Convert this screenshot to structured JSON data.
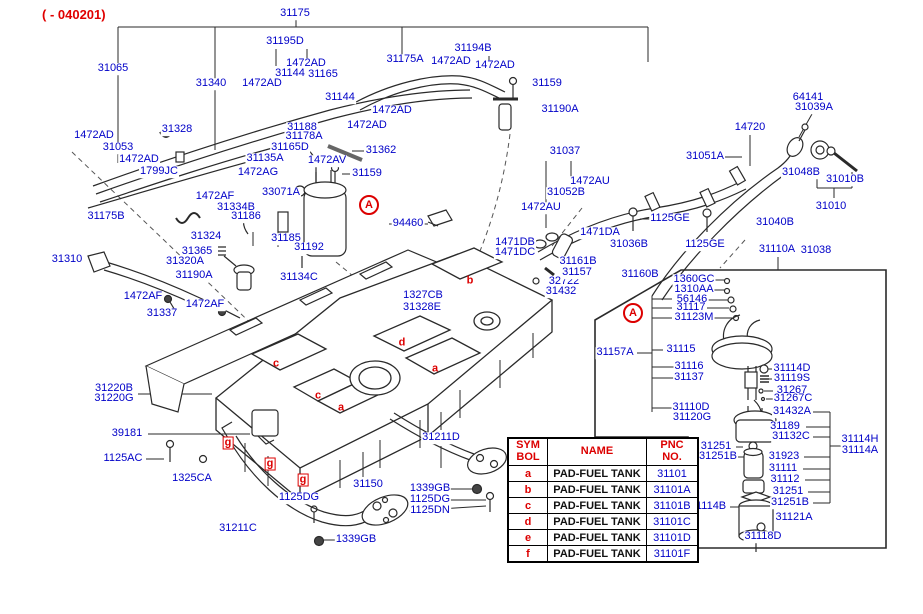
{
  "header": {
    "revision_code": "( - 040201)"
  },
  "colors": {
    "part_label": "#0000c8",
    "accent_red": "#dc0000",
    "line": "#2a2a2a",
    "background": "#ffffff"
  },
  "part_labels": [
    {
      "text": "31175",
      "x": 295,
      "y": 14
    },
    {
      "text": "31195D",
      "x": 285,
      "y": 42
    },
    {
      "text": "31065",
      "x": 113,
      "y": 69
    },
    {
      "text": "31340",
      "x": 211,
      "y": 84
    },
    {
      "text": "1472AD",
      "x": 306,
      "y": 64
    },
    {
      "text": "31144",
      "x": 290,
      "y": 74
    },
    {
      "text": "31165",
      "x": 323,
      "y": 75
    },
    {
      "text": "1472AD",
      "x": 262,
      "y": 84
    },
    {
      "text": "31144",
      "x": 340,
      "y": 98
    },
    {
      "text": "31175A",
      "x": 405,
      "y": 60
    },
    {
      "text": "1472AD",
      "x": 451,
      "y": 62
    },
    {
      "text": "31194B",
      "x": 473,
      "y": 49
    },
    {
      "text": "1472AD",
      "x": 495,
      "y": 66
    },
    {
      "text": "31159",
      "x": 547,
      "y": 84
    },
    {
      "text": "31190A",
      "x": 560,
      "y": 110
    },
    {
      "text": "1472AD",
      "x": 392,
      "y": 111
    },
    {
      "text": "1472AD",
      "x": 367,
      "y": 126
    },
    {
      "text": "31188",
      "x": 302,
      "y": 128
    },
    {
      "text": "31178A",
      "x": 304,
      "y": 137
    },
    {
      "text": "31165D",
      "x": 290,
      "y": 148
    },
    {
      "text": "31362",
      "x": 381,
      "y": 151
    },
    {
      "text": "31135A",
      "x": 265,
      "y": 159
    },
    {
      "text": "1472AG",
      "x": 258,
      "y": 173
    },
    {
      "text": "1472AV",
      "x": 327,
      "y": 161
    },
    {
      "text": "31159",
      "x": 367,
      "y": 174
    },
    {
      "text": "1472AD",
      "x": 94,
      "y": 136
    },
    {
      "text": "31053",
      "x": 118,
      "y": 148
    },
    {
      "text": "31328",
      "x": 177,
      "y": 130
    },
    {
      "text": "1472AD",
      "x": 139,
      "y": 160
    },
    {
      "text": "1799JC",
      "x": 159,
      "y": 172
    },
    {
      "text": "33071A",
      "x": 281,
      "y": 193
    },
    {
      "text": "1472AF",
      "x": 215,
      "y": 197
    },
    {
      "text": "31334B",
      "x": 236,
      "y": 208
    },
    {
      "text": "31186",
      "x": 246,
      "y": 217
    },
    {
      "text": "31175B",
      "x": 106,
      "y": 217
    },
    {
      "text": "31324",
      "x": 206,
      "y": 237
    },
    {
      "text": "31310",
      "x": 67,
      "y": 260
    },
    {
      "text": "31365",
      "x": 197,
      "y": 252
    },
    {
      "text": "31320A",
      "x": 185,
      "y": 262
    },
    {
      "text": "31190A",
      "x": 194,
      "y": 276
    },
    {
      "text": "94460",
      "x": 408,
      "y": 224
    },
    {
      "text": "31185",
      "x": 286,
      "y": 239
    },
    {
      "text": "31192",
      "x": 309,
      "y": 248
    },
    {
      "text": "31134C",
      "x": 299,
      "y": 278
    },
    {
      "text": "31337",
      "x": 162,
      "y": 314
    },
    {
      "text": "1472AF",
      "x": 143,
      "y": 297
    },
    {
      "text": "1472AF",
      "x": 205,
      "y": 305
    },
    {
      "text": "1327CB",
      "x": 423,
      "y": 296
    },
    {
      "text": "31328E",
      "x": 422,
      "y": 308
    },
    {
      "text": "31220B",
      "x": 114,
      "y": 389
    },
    {
      "text": "31220G",
      "x": 114,
      "y": 399
    },
    {
      "text": "39181",
      "x": 127,
      "y": 434
    },
    {
      "text": "1125AC",
      "x": 123,
      "y": 459
    },
    {
      "text": "1325CA",
      "x": 192,
      "y": 479
    },
    {
      "text": "1125DG",
      "x": 299,
      "y": 498
    },
    {
      "text": "31211C",
      "x": 238,
      "y": 529
    },
    {
      "text": "1339GB",
      "x": 356,
      "y": 540
    },
    {
      "text": "31150",
      "x": 368,
      "y": 485
    },
    {
      "text": "31211D",
      "x": 441,
      "y": 438
    },
    {
      "text": "1339GB",
      "x": 430,
      "y": 489
    },
    {
      "text": "1125DG",
      "x": 430,
      "y": 500
    },
    {
      "text": "1125DN",
      "x": 430,
      "y": 511
    },
    {
      "text": "31037",
      "x": 565,
      "y": 152
    },
    {
      "text": "1472AU",
      "x": 590,
      "y": 182
    },
    {
      "text": "31052B",
      "x": 566,
      "y": 193
    },
    {
      "text": "1472AU",
      "x": 541,
      "y": 208
    },
    {
      "text": "31051A",
      "x": 705,
      "y": 157
    },
    {
      "text": "1125GE",
      "x": 670,
      "y": 219
    },
    {
      "text": "1471DB",
      "x": 515,
      "y": 243
    },
    {
      "text": "1471DC",
      "x": 515,
      "y": 253
    },
    {
      "text": "1471DA",
      "x": 600,
      "y": 233
    },
    {
      "text": "31036B",
      "x": 629,
      "y": 245
    },
    {
      "text": "1125GE",
      "x": 705,
      "y": 245
    },
    {
      "text": "32722",
      "x": 564,
      "y": 282
    },
    {
      "text": "31432",
      "x": 561,
      "y": 292
    },
    {
      "text": "31161B",
      "x": 578,
      "y": 262
    },
    {
      "text": "31157",
      "x": 577,
      "y": 273
    },
    {
      "text": "31160B",
      "x": 640,
      "y": 275
    },
    {
      "text": "14720",
      "x": 750,
      "y": 128
    },
    {
      "text": "64141",
      "x": 808,
      "y": 98
    },
    {
      "text": "31039A",
      "x": 814,
      "y": 108
    },
    {
      "text": "31048B",
      "x": 801,
      "y": 173
    },
    {
      "text": "31010B",
      "x": 845,
      "y": 180
    },
    {
      "text": "31010",
      "x": 831,
      "y": 207
    },
    {
      "text": "31040B",
      "x": 775,
      "y": 223
    },
    {
      "text": "31110A",
      "x": 777,
      "y": 250
    },
    {
      "text": "31038",
      "x": 816,
      "y": 251
    },
    {
      "text": "1360GC",
      "x": 694,
      "y": 280
    },
    {
      "text": "1310AA",
      "x": 694,
      "y": 290
    },
    {
      "text": "56146",
      "x": 692,
      "y": 300
    },
    {
      "text": "31117",
      "x": 691,
      "y": 308
    },
    {
      "text": "31123M",
      "x": 694,
      "y": 318
    },
    {
      "text": "31157A",
      "x": 615,
      "y": 353
    },
    {
      "text": "31115",
      "x": 681,
      "y": 350
    },
    {
      "text": "31116",
      "x": 689,
      "y": 367
    },
    {
      "text": "31137",
      "x": 689,
      "y": 378
    },
    {
      "text": "31114D",
      "x": 792,
      "y": 369
    },
    {
      "text": "31119S",
      "x": 792,
      "y": 379
    },
    {
      "text": "31267",
      "x": 792,
      "y": 391
    },
    {
      "text": "31267C",
      "x": 793,
      "y": 399
    },
    {
      "text": "31432A",
      "x": 792,
      "y": 412
    },
    {
      "text": "31110D",
      "x": 691,
      "y": 408
    },
    {
      "text": "31120G",
      "x": 692,
      "y": 418
    },
    {
      "text": "31189",
      "x": 785,
      "y": 427
    },
    {
      "text": "31132C",
      "x": 791,
      "y": 437
    },
    {
      "text": "31251",
      "x": 716,
      "y": 447
    },
    {
      "text": "31251B",
      "x": 718,
      "y": 457
    },
    {
      "text": "31923",
      "x": 784,
      "y": 457
    },
    {
      "text": "31111",
      "x": 783,
      "y": 469
    },
    {
      "text": "31112",
      "x": 785,
      "y": 480
    },
    {
      "text": "31251",
      "x": 788,
      "y": 492
    },
    {
      "text": "31251B",
      "x": 790,
      "y": 503
    },
    {
      "text": "31114H",
      "x": 860,
      "y": 440
    },
    {
      "text": "31114A",
      "x": 860,
      "y": 451
    },
    {
      "text": "31114B",
      "x": 708,
      "y": 507
    },
    {
      "text": "31121A",
      "x": 794,
      "y": 518
    },
    {
      "text": "31118D",
      "x": 763,
      "y": 537
    }
  ],
  "detail_markers": [
    {
      "text": "A",
      "x": 369,
      "y": 205
    },
    {
      "text": "A",
      "x": 633,
      "y": 313
    }
  ],
  "tank_symbols": [
    {
      "text": "b",
      "x": 470,
      "y": 281,
      "boxed": false
    },
    {
      "text": "c",
      "x": 276,
      "y": 364,
      "boxed": false
    },
    {
      "text": "d",
      "x": 402,
      "y": 343,
      "boxed": false
    },
    {
      "text": "a",
      "x": 435,
      "y": 369,
      "boxed": false
    },
    {
      "text": "c",
      "x": 318,
      "y": 396,
      "boxed": false
    },
    {
      "text": "a",
      "x": 341,
      "y": 408,
      "boxed": false
    },
    {
      "text": "g",
      "x": 228,
      "y": 443,
      "boxed": true
    },
    {
      "text": "g",
      "x": 270,
      "y": 464,
      "boxed": true
    },
    {
      "text": "g",
      "x": 303,
      "y": 480,
      "boxed": true
    }
  ],
  "parts_table": {
    "headers": [
      [
        "SYM",
        "BOL"
      ],
      [
        "NAME"
      ],
      [
        "PNC",
        "NO."
      ]
    ],
    "rows": [
      {
        "symbol": "a",
        "name": "PAD-FUEL TANK",
        "pnc": "31101"
      },
      {
        "symbol": "b",
        "name": "PAD-FUEL TANK",
        "pnc": "31101A"
      },
      {
        "symbol": "c",
        "name": "PAD-FUEL TANK",
        "pnc": "31101B"
      },
      {
        "symbol": "d",
        "name": "PAD-FUEL TANK",
        "pnc": "31101C"
      },
      {
        "symbol": "e",
        "name": "PAD-FUEL TANK",
        "pnc": "31101D"
      },
      {
        "symbol": "f",
        "name": "PAD-FUEL TANK",
        "pnc": "31101F"
      }
    ]
  }
}
